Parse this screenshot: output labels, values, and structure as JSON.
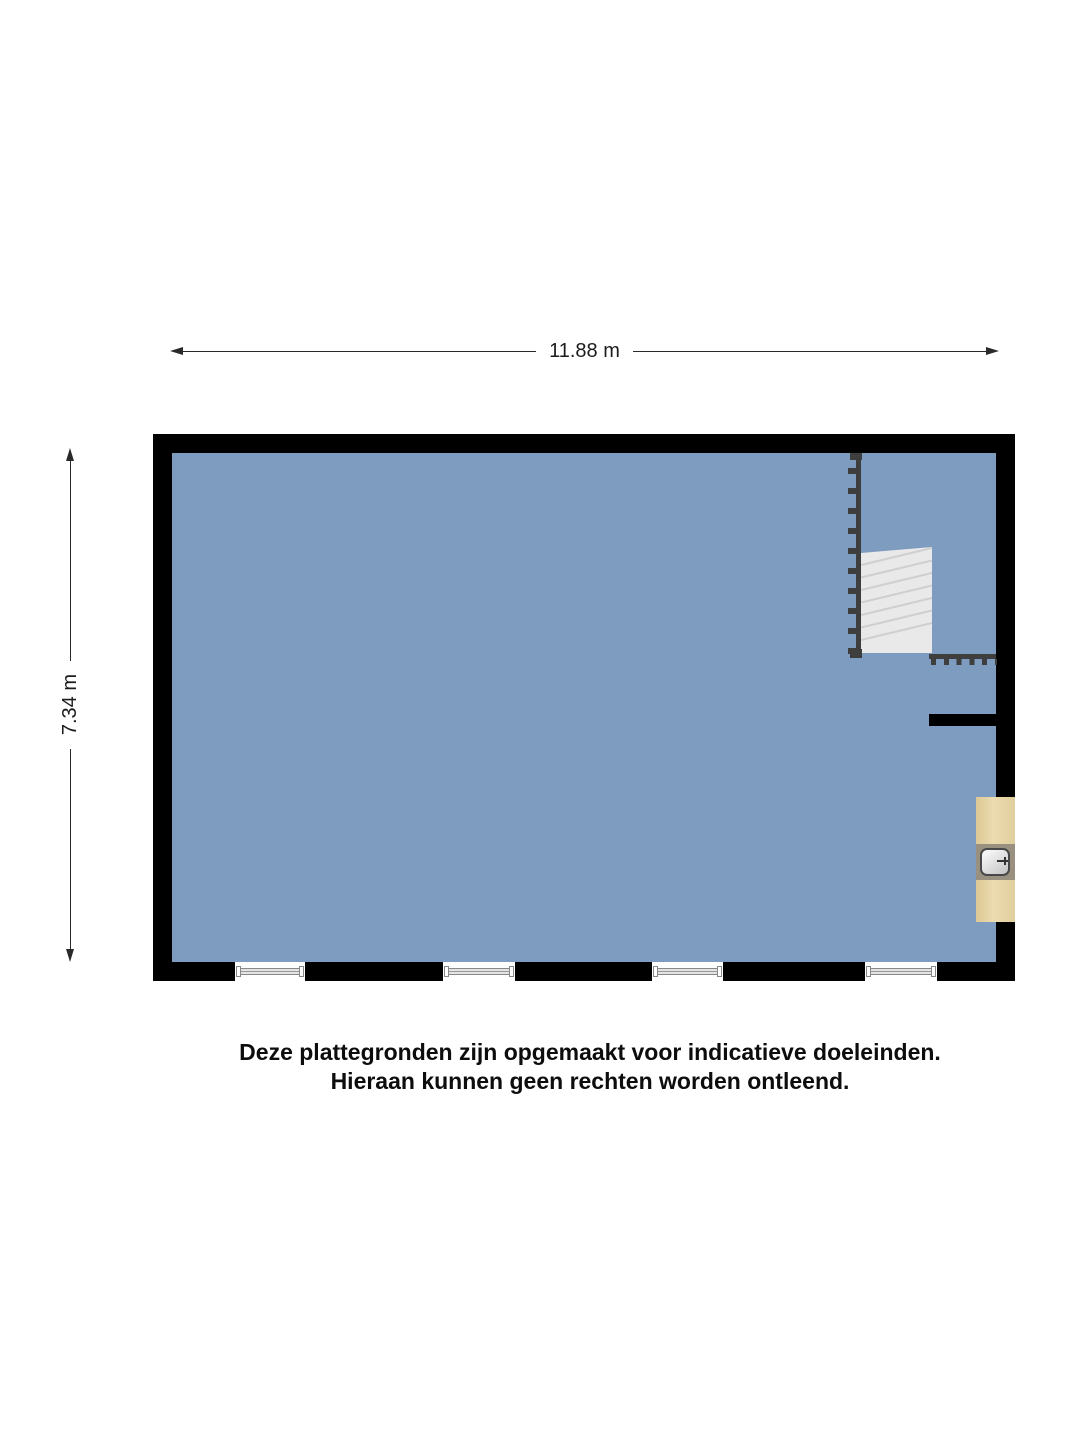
{
  "dimensions": {
    "width_label": "11.88 m",
    "height_label": "7.34 m"
  },
  "disclaimer": {
    "line1": "Deze plattegronden zijn opgemaakt voor indicatieve doeleinden.",
    "line2": "Hieraan kunnen geen rechten worden ontleend."
  },
  "floorplan": {
    "windows_count": 4,
    "colors": {
      "wall": "#000000",
      "floor": "#7E9BC0",
      "stair_fill": "#E9E9E9",
      "stair_line": "#CFCFCF",
      "railing": "#3E3E3E",
      "counter": "#E5D2A3",
      "sink_panel": "#9A9080",
      "sink_border": "#484848",
      "window_frame": "#888888",
      "dim_line": "#2A2A2A"
    }
  }
}
